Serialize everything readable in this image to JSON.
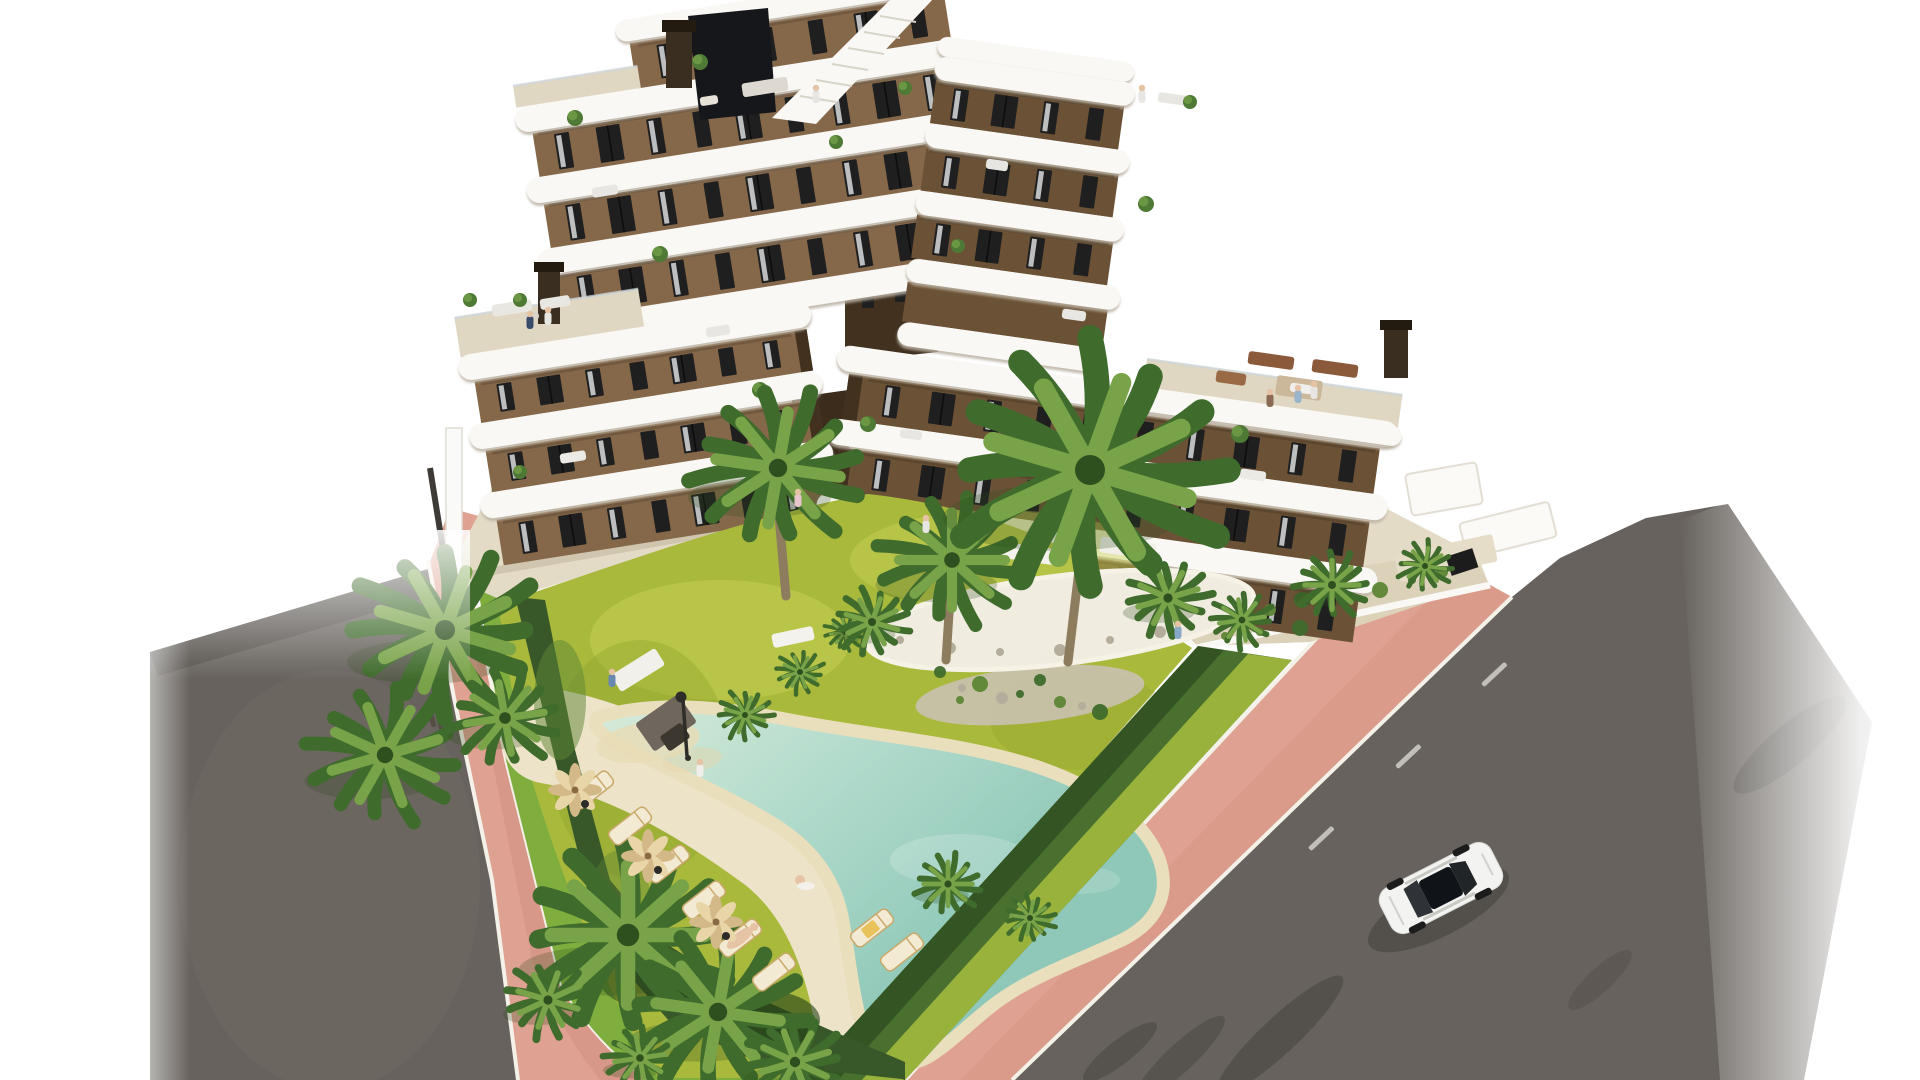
{
  "scene": {
    "type": "3d-architectural-rendering",
    "description": "Aerial 3D render of a modern 7-storey apartment building with brown facade and white rounded wrap-around balconies, communal garden with lawn, palm trees, boomerang-shaped pool with sun loungers and parasols, pink perimeter sidewalks, asphalt streets and a single white car driving on the right-hand road. Pure white background (cut-out render).",
    "objects": [
      "apartment-building",
      "rooftop-terrace",
      "staircase-bulkhead",
      "chimneys",
      "balconies",
      "windows-with-curtains",
      "residents-on-terraces",
      "ground-floor-patios",
      "communal-garden",
      "lawn",
      "palm-trees",
      "gravel-island",
      "boomerang-pool",
      "beach-entry",
      "sun-loungers",
      "parasols",
      "garden-lamp",
      "trimmed-hedge",
      "planting-beds",
      "pink-sidewalk",
      "white-curbs",
      "asphalt-road-left",
      "asphalt-road-right",
      "lane-markings",
      "white-car",
      "boundary-wall"
    ],
    "building": {
      "visible_floors": 7,
      "balcony_style": "white rounded bands",
      "facade_material": "brown render"
    },
    "pool": {
      "shape": "boomerang with beach entry",
      "surround": "cream deck"
    },
    "vehicle": {
      "type": "sedan car",
      "color": "white",
      "location": "right road, driving up-right"
    },
    "people_visible": 12
  },
  "palette": {
    "background": "#ffffff",
    "road": "#67625d",
    "road_shadow": "#45423d",
    "road_light": "#736d66",
    "lane_marking": "#d9d6cf",
    "sidewalk_pink": "#dfa192",
    "sidewalk_pink_dark": "#d08e7f",
    "curb_white": "#f4f1e9",
    "lawn": "#a9b93c",
    "lawn_light": "#c9d254",
    "lawn_dark": "#8aa02c",
    "lawn_strip": "#7fae3e",
    "hedge": "#4a7030",
    "hedge_light": "#a6bd3e",
    "hedge_dark": "#2e4e20",
    "bed_dark": "#39582a",
    "palm_light": "#79a348",
    "palm_dark": "#3f6b2c",
    "trunk": "#8d7d5e",
    "pool_water": "#aed8cc",
    "pool_water_deep": "#8cc3b4",
    "pool_sand": "#eadfbc",
    "deck": "#ece3c8",
    "island_gravel": "#f0ece0",
    "pebbles": "#c9c2b0",
    "paving": "#e3dbc6",
    "terrace_paving": "#e0d7c2",
    "structure_white": "#f9f8f4",
    "band_shadow": "#cfc8ba",
    "facade": "#85684a",
    "facade_dark": "#6b5236",
    "facade_shadow": "#42311f",
    "window_glass": "#1f1f20",
    "curtain": "#d9dbdc",
    "car_body": "#f3f3f1",
    "car_glass": "#16191c",
    "umbrella": "#e9d6a8",
    "umbrella_dark": "#d3b987",
    "lounger": "#f2ead2",
    "chimney_color": "#3a2e20",
    "skin": "#e6c3a5"
  }
}
